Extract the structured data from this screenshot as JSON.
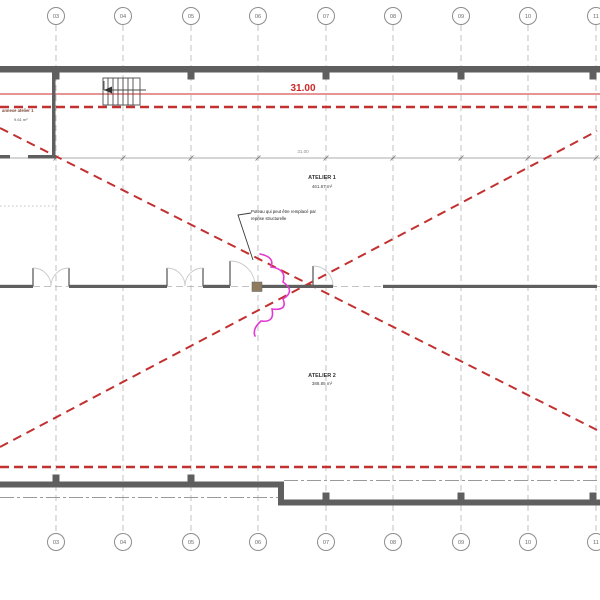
{
  "grids": {
    "labels": [
      "03",
      "04",
      "05",
      "06",
      "07",
      "08",
      "09",
      "10",
      "11"
    ]
  },
  "dimensions": {
    "overall_red": "31.00",
    "overall_grey": "31.00"
  },
  "rooms": {
    "atelier1": {
      "name": "ATELIER 1",
      "area": "461.87 m²"
    },
    "atelier2": {
      "name": "ATELIER 2",
      "area": "388.85 m²"
    },
    "annexe": {
      "name": "annexe atelier 1",
      "area": "9.61 m²"
    }
  },
  "annotation": {
    "line1": "Poteau qui peut être remplacé par",
    "line2": "reprise structurelle"
  },
  "colors": {
    "red_marking": "#c23030",
    "red_dimension": "#cc2626",
    "magenta_cloud": "#e23bd3",
    "wall_grey": "#5f5f5f",
    "grid_grey": "#b4b4b4",
    "column_tan": "#8f7c5e"
  }
}
